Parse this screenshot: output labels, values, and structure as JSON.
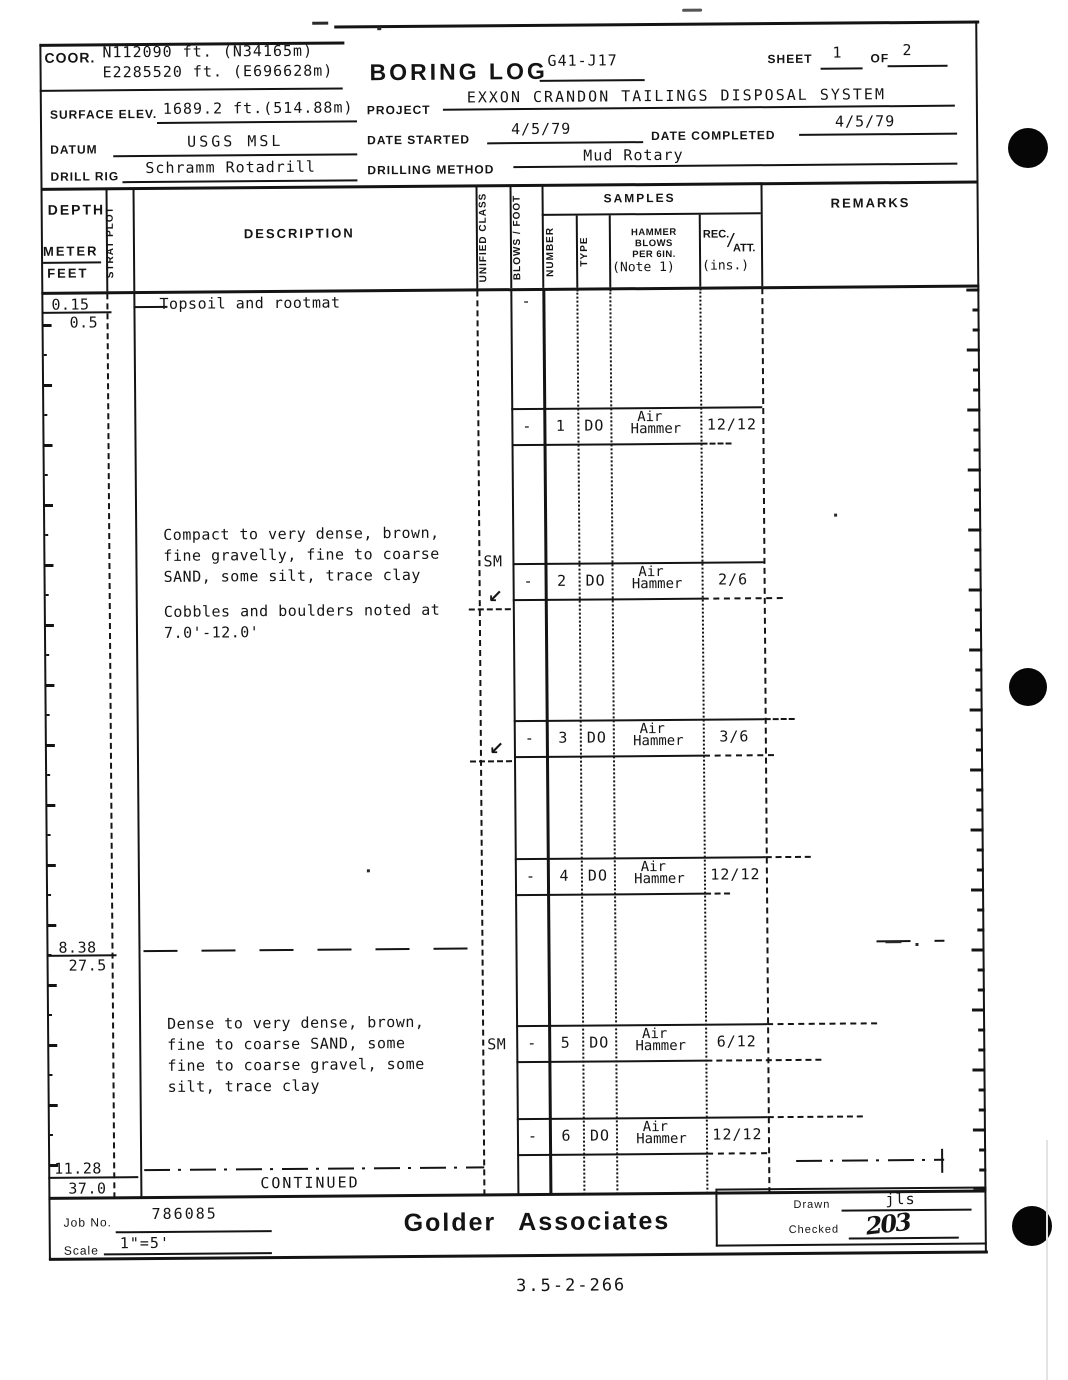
{
  "ink": "#141414",
  "paper": "#ffffff",
  "header": {
    "coor_label": "COOR.",
    "coor_north": "N112090 ft. (N34165m)",
    "coor_east": "E2285520 ft. (E696628m)",
    "title": "BORING LOG",
    "boring_id": "G41-J17",
    "sheet_label": "SHEET",
    "sheet_no": "1",
    "of_label": "OF",
    "sheets_total": "2",
    "surface_elev_label": "SURFACE ELEV.",
    "surface_elev": "1689.2 ft.(514.88m)",
    "project_label": "PROJECT",
    "project": "EXXON CRANDON TAILINGS DISPOSAL SYSTEM",
    "datum_label": "DATUM",
    "datum": "USGS MSL",
    "date_started_label": "DATE STARTED",
    "date_started": "4/5/79",
    "date_completed_label": "DATE COMPLETED",
    "date_completed": "4/5/79",
    "drill_rig_label": "DRILL RIG",
    "drill_rig": "Schramm Rotadrill",
    "drilling_method_label": "DRILLING METHOD",
    "drilling_method": "Mud Rotary"
  },
  "columns": {
    "depth": "DEPTH",
    "meter": "METER",
    "feet": "FEET",
    "strat_plot": "STRAT PLOT",
    "description": "DESCRIPTION",
    "unified_class": "UNIFIED CLASS",
    "blows_foot": "BLOWS / FOOT",
    "samples": "SAMPLES",
    "number": "NUMBER",
    "type": "TYPE",
    "hammer_l1": "HAMMER",
    "hammer_l2": "BLOWS",
    "hammer_l3": "PER 6IN.",
    "hammer_note": "(Note 1)",
    "rec": "REC.",
    "slash": "/",
    "att": "ATT.",
    "rec_units": "(ins.)",
    "remarks": "REMARKS"
  },
  "log": {
    "depth1_m": "0.15",
    "depth1_ft": "0.5",
    "stratum1": "Topsoil and rootmat",
    "stratum1_blows": "-",
    "stratum2_l1": "Compact to very dense, brown,",
    "stratum2_l2": "fine gravelly, fine to coarse",
    "stratum2_l3": "SAND, some silt, trace clay",
    "stratum2_n1": "Cobbles and boulders noted at",
    "stratum2_n2": "7.0'-12.0'",
    "stratum2_class": "SM",
    "depth2_m": "8.38",
    "depth2_ft": "27.5",
    "stratum3_l1": "Dense to very dense, brown,",
    "stratum3_l2": "fine to coarse SAND, some",
    "stratum3_l3": "fine to coarse gravel, some",
    "stratum3_l4": "silt, trace clay",
    "stratum3_class": "SM",
    "depth3_m": "11.28",
    "depth3_ft": "37.0",
    "continued": "CONTINUED",
    "samples": [
      {
        "blows": "-",
        "number": "1",
        "type": "DO",
        "hammer1": "Air",
        "hammer2": "Hammer",
        "rec_att": "12/12"
      },
      {
        "blows": "-",
        "number": "2",
        "type": "DO",
        "hammer1": "Air",
        "hammer2": "Hammer",
        "rec_att": "2/6"
      },
      {
        "blows": "-",
        "number": "3",
        "type": "DO",
        "hammer1": "Air",
        "hammer2": "Hammer",
        "rec_att": "3/6"
      },
      {
        "blows": "-",
        "number": "4",
        "type": "DO",
        "hammer1": "Air",
        "hammer2": "Hammer",
        "rec_att": "12/12"
      },
      {
        "blows": "-",
        "number": "5",
        "type": "DO",
        "hammer1": "Air",
        "hammer2": "Hammer",
        "rec_att": "6/12"
      },
      {
        "blows": "-",
        "number": "6",
        "type": "DO",
        "hammer1": "Air",
        "hammer2": "Hammer",
        "rec_att": "12/12"
      }
    ]
  },
  "footer": {
    "job_no_label": "Job No.",
    "job_no": "786085",
    "scale_label": "Scale",
    "scale": "1\"=5'",
    "company": "Golder Associates",
    "drawn_label": "Drawn",
    "drawn": "jls",
    "checked_label": "Checked",
    "checked_signature": "203"
  },
  "doc_code": "3.5-2-266"
}
